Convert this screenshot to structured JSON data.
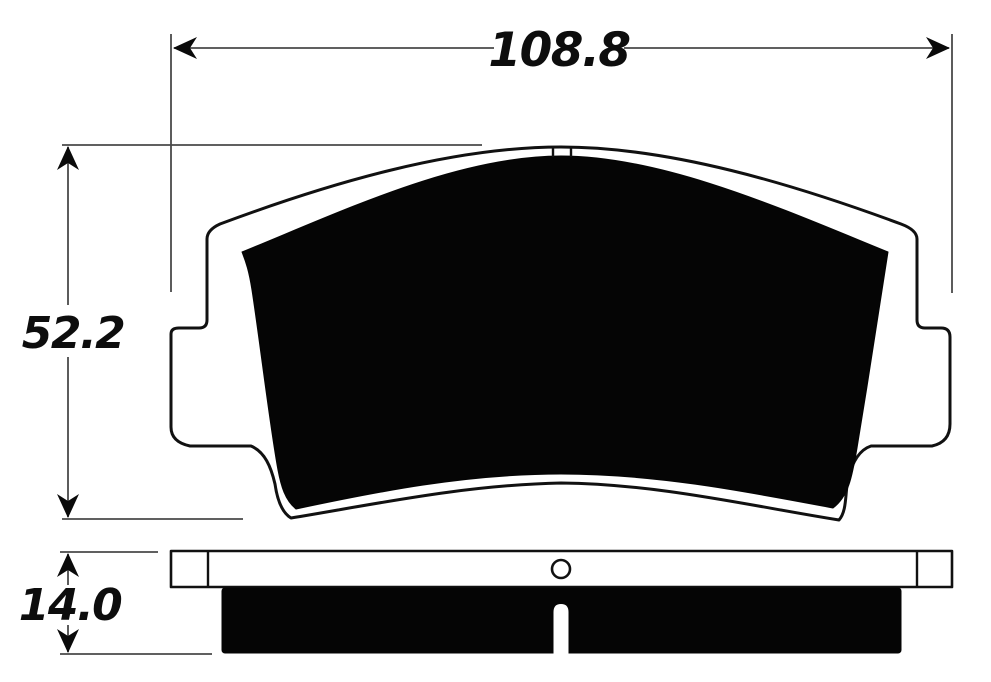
{
  "drawing": {
    "type": "brake-pad-dimensional-drawing",
    "views": {
      "front_view": "pad front elevation",
      "side_view": "pad bottom edge profile"
    },
    "dimensions": {
      "width": {
        "value": "108.8"
      },
      "height": {
        "value": "52.2"
      },
      "thickness": {
        "value": "14.0"
      }
    },
    "colors": {
      "outline": "#111111",
      "friction_fill": "#050505",
      "dimension_line": "#4a4a4a",
      "background": "#ffffff"
    }
  }
}
